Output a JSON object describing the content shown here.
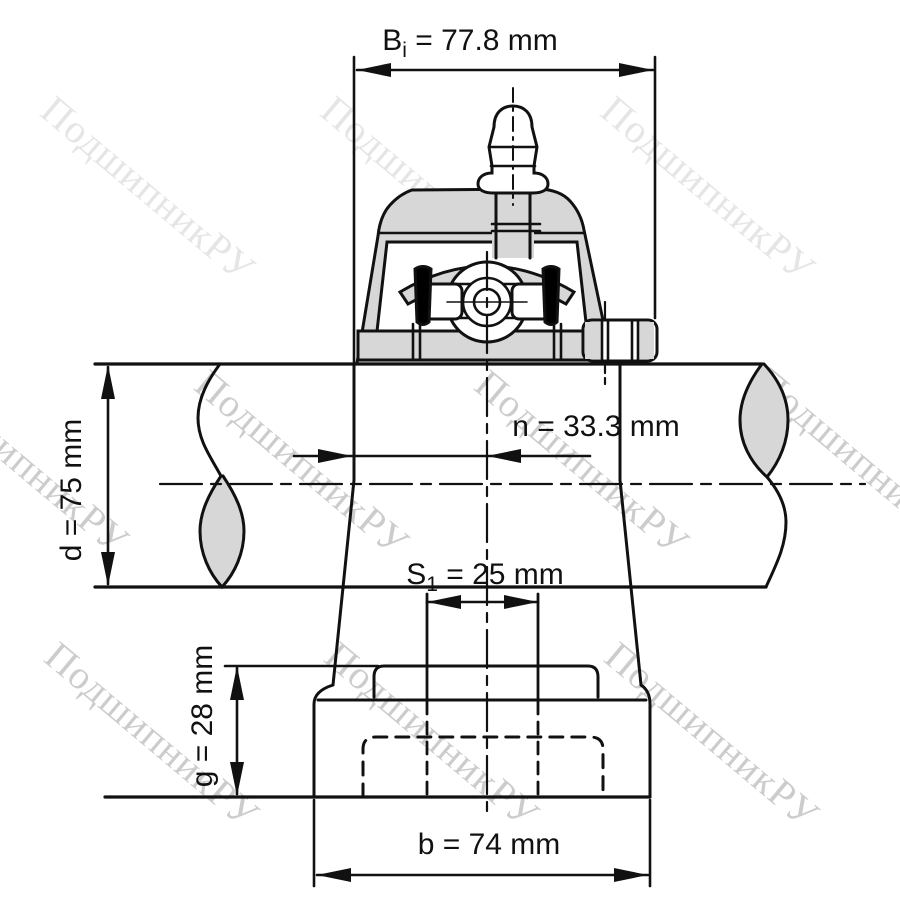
{
  "watermark": {
    "text": "ПодшипникРУ"
  },
  "dimensions": {
    "bi": {
      "symbol": "B",
      "subscript": "i",
      "rest": " = 77.8 mm"
    },
    "n": {
      "text": "n = 33.3 mm"
    },
    "d": {
      "text": "d = 75 mm"
    },
    "s1": {
      "symbol": "S",
      "subscript": "1",
      "rest": " = 25 mm"
    },
    "g": {
      "text": "g = 28 mm"
    },
    "b": {
      "text": "b = 74 mm"
    }
  },
  "colors": {
    "line": "#111111",
    "section_fill": "#d7d7d7",
    "seal_fill": "#000000",
    "watermark_light": "rgba(0,0,0,0.10)",
    "watermark_dark": "rgba(0,0,0,0.20)"
  }
}
